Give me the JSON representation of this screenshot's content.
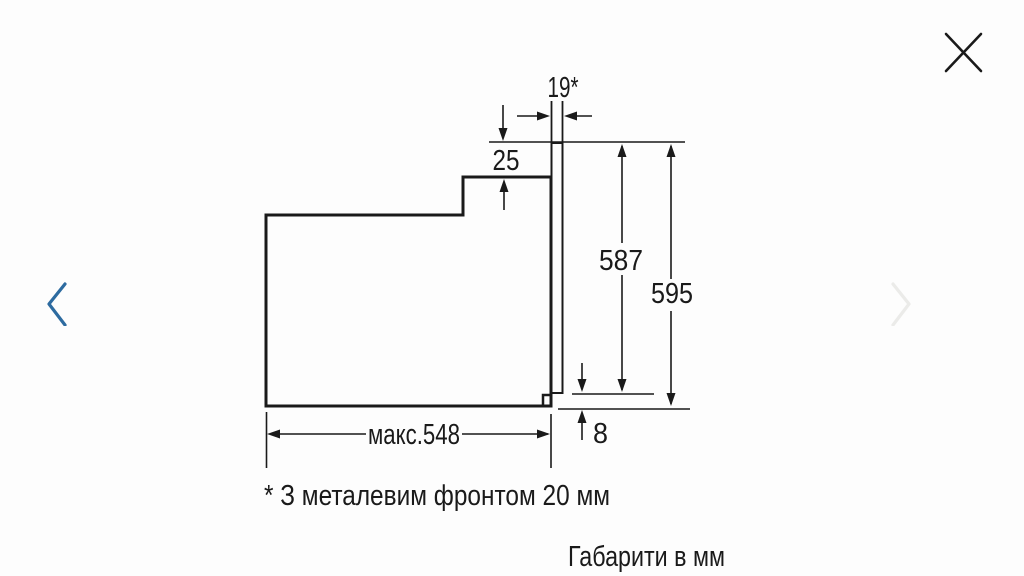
{
  "viewer": {
    "nav": {
      "prev_enabled": true,
      "next_enabled": false
    }
  },
  "diagram": {
    "dims": {
      "front_thickness": "19*",
      "top_recess": "25",
      "niche_height": "587",
      "total_height": "595",
      "bottom_gap": "8",
      "max_depth": "макс.548"
    },
    "footnote": "* З металевим фронтом 20 мм",
    "units_note": "Габарити в мм"
  },
  "colors": {
    "line": "#1a1a1a",
    "nav_active": "#2d6ba0",
    "nav_disabled": "#ebebe9",
    "background": "#fdfdfd"
  }
}
